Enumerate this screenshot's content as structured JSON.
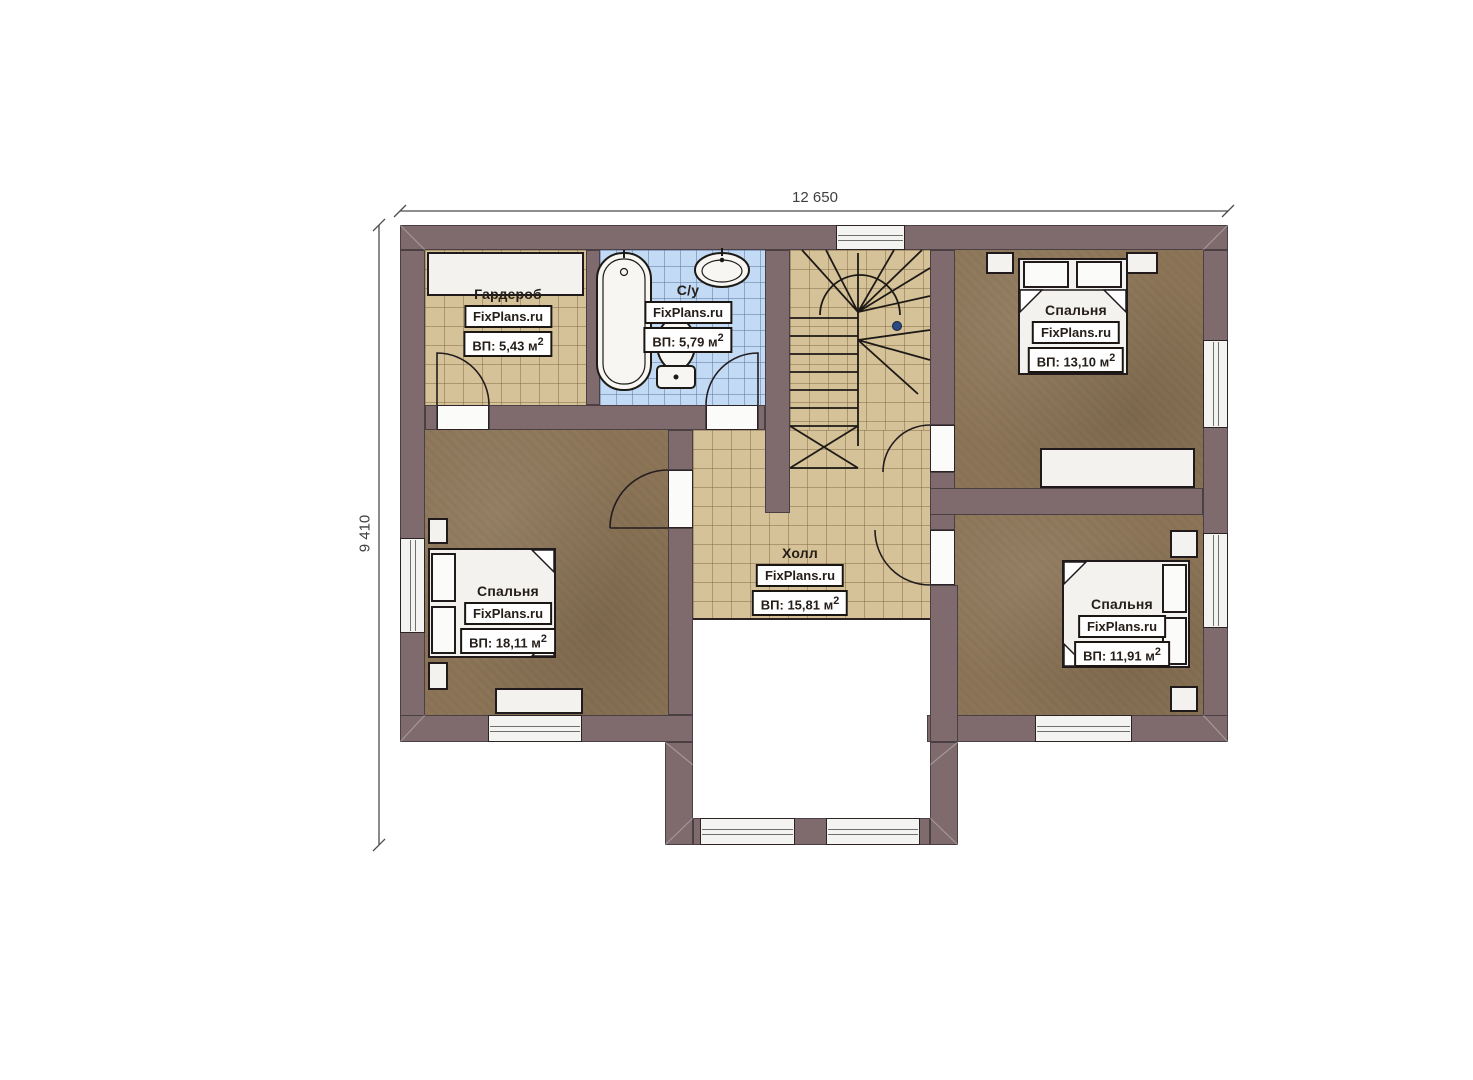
{
  "page": {
    "type": "architectural-floor-plan",
    "background": "#ffffff"
  },
  "dimensions": {
    "width_label": "12 650",
    "height_label": "9 410"
  },
  "branding": {
    "watermark": "FixPlans.ru"
  },
  "rooms": {
    "wardrobe": {
      "name": "Гардероб",
      "watermark": "FixPlans.ru",
      "area": "ВП: 5,43 м",
      "area_sup": "2"
    },
    "bathroom": {
      "name": "С/у",
      "watermark": "FixPlans.ru",
      "area": "ВП: 5,79 м",
      "area_sup": "2"
    },
    "bedroom_top_right": {
      "name": "Спальня",
      "watermark": "FixPlans.ru",
      "area": "ВП: 13,10 м",
      "area_sup": "2"
    },
    "hall": {
      "name": "Холл",
      "watermark": "FixPlans.ru",
      "area": "ВП: 15,81 м",
      "area_sup": "2"
    },
    "bedroom_left": {
      "name": "Спальня",
      "watermark": "FixPlans.ru",
      "area": "ВП: 18,11 м",
      "area_sup": "2"
    },
    "bedroom_bottom_right": {
      "name": "Спальня",
      "watermark": "FixPlans.ru",
      "area": "ВП: 11,91 м",
      "area_sup": "2"
    }
  },
  "colors": {
    "wall": "#7f6b6e",
    "tile_tan": "#d6c298",
    "tile_blue": "#c2daf3",
    "carpet": "#8c7557",
    "outline": "#2b2326",
    "fixture": "#f3f2ef"
  }
}
